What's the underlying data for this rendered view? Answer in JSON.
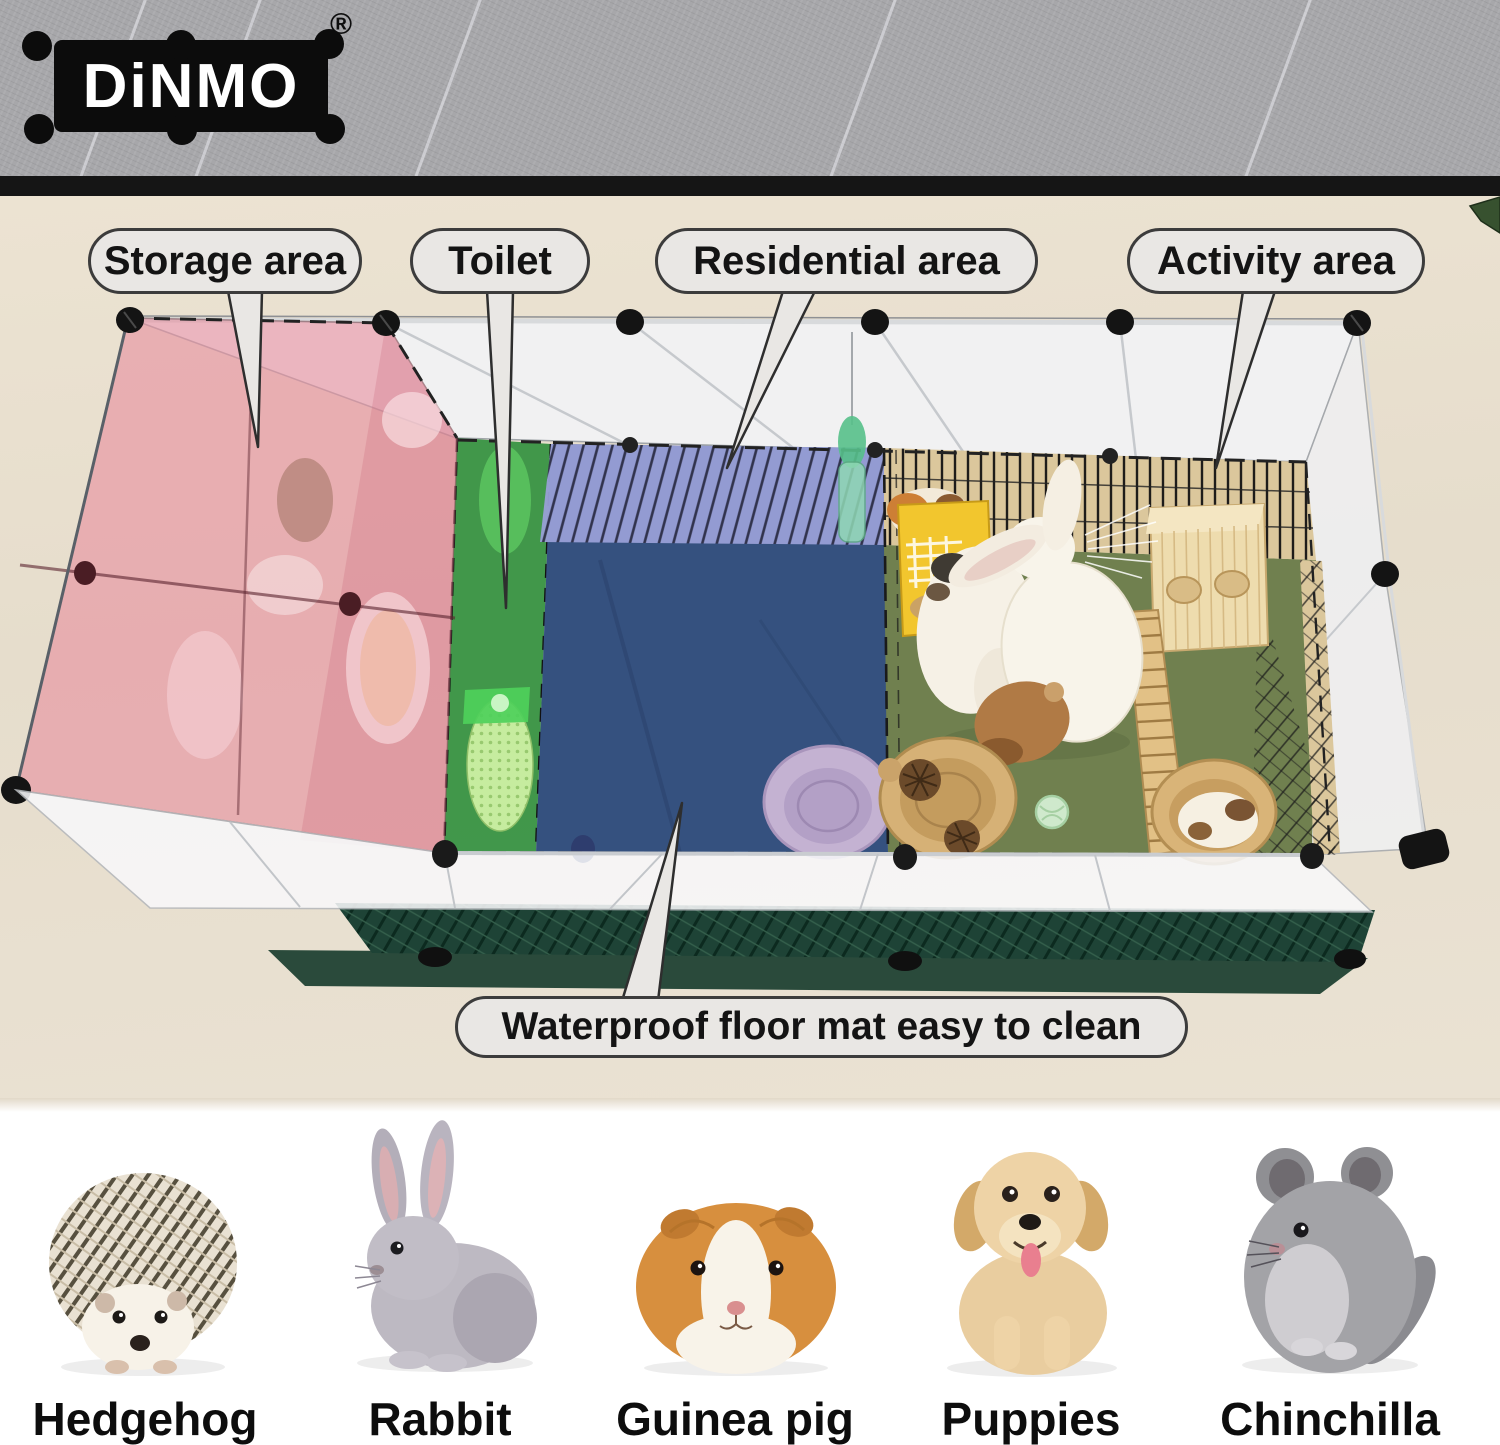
{
  "brand": {
    "logo_text": "DiNMO",
    "registered_mark": "®"
  },
  "callouts": {
    "storage": "Storage area",
    "toilet": "Toilet",
    "residential": "Residential area",
    "activity": "Activity area",
    "floor_mat": "Waterproof floor mat easy to clean"
  },
  "suitable_pets": [
    {
      "label": "Hedgehog"
    },
    {
      "label": "Rabbit"
    },
    {
      "label": "Guinea pig"
    },
    {
      "label": "Puppies"
    },
    {
      "label": "Chinchilla"
    }
  ],
  "colors": {
    "storage_zone": "#e891a0",
    "toilet_zone": "#2f8f3c",
    "residential_mat": "#35517f",
    "residential_fence": "#9aa0d8",
    "activity_mat": "#70804f",
    "base_mat": "#2a4a3b",
    "feeder": "#f2c62e",
    "callout_fill": "#e9e7e4",
    "wall": "#a7a7aa",
    "floor": "#e9e0cf"
  }
}
